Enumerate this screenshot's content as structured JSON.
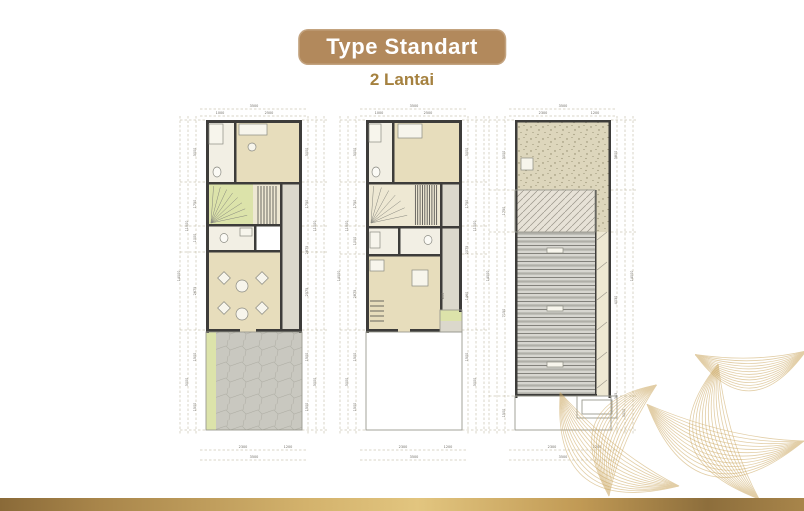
{
  "header": {
    "badge_label": "Type Standart",
    "subtitle": "2 Lantai"
  },
  "colors": {
    "badge": "#b2895c",
    "subtitle_text": "#a5813f",
    "wall": "#3d3c3a",
    "dim_text": "#6e6b64",
    "guide_line": "#b5ad90",
    "gold_bar": "#c19a55",
    "leaf_line": "#cba760",
    "rooms": {
      "white": "#f2efe4",
      "beige": "#e7ddbc",
      "cream": "#eee8d3",
      "green": "#dce3aa",
      "gray": "#dbd8cc",
      "paving": "paving",
      "speckle": "speckle",
      "hatch": "hatch",
      "roof": "roof"
    }
  },
  "plans": [
    {
      "name": "first-floor-plan",
      "stubs": [
        20,
        82,
        126,
        152,
        230,
        330
      ],
      "rooms": [
        [
          34,
          20,
          30,
          64,
          "white"
        ],
        [
          64,
          20,
          66,
          64,
          "beige"
        ],
        [
          34,
          84,
          47,
          42,
          "green"
        ],
        [
          81,
          84,
          27,
          42,
          "cream"
        ],
        [
          108,
          84,
          22,
          148,
          "gray"
        ],
        [
          34,
          126,
          48,
          26,
          "white"
        ],
        [
          34,
          152,
          74,
          80,
          "beige"
        ],
        [
          34,
          232,
          10,
          98,
          "green"
        ],
        [
          44,
          232,
          86,
          98,
          "paving"
        ]
      ],
      "walls": [
        [
          34,
          20,
          96,
          3
        ],
        [
          34,
          20,
          3,
          213
        ],
        [
          127,
          20,
          3,
          213
        ],
        [
          62,
          20,
          2.5,
          64
        ],
        [
          34,
          82,
          96,
          2.5
        ],
        [
          34,
          124,
          76,
          2.5
        ],
        [
          34,
          150,
          76,
          2.5
        ],
        [
          82,
          124,
          2.5,
          28
        ],
        [
          108,
          84,
          2.5,
          148
        ],
        [
          34,
          229,
          34,
          3
        ],
        [
          84,
          229,
          46,
          3
        ]
      ],
      "features": [
        {
          "t": "outline",
          "x": 34,
          "y": 232,
          "w": 96,
          "h": 98
        },
        {
          "t": "fan",
          "x": 39,
          "y": 123,
          "r": 37,
          "a1": -86,
          "a2": -12,
          "n": 7
        },
        {
          "t": "hsteps",
          "x": 83,
          "y": 86,
          "w": 24,
          "h": 38,
          "n": 7
        },
        {
          "t": "box",
          "x": 67,
          "y": 24,
          "w": 28,
          "h": 11
        },
        {
          "t": "circle",
          "x": 80,
          "y": 47,
          "r": 4
        },
        {
          "t": "box",
          "x": 37,
          "y": 24,
          "w": 14,
          "h": 20
        },
        {
          "t": "oval",
          "x": 45,
          "y": 72,
          "rx": 4,
          "ry": 5
        },
        {
          "t": "oval",
          "x": 52,
          "y": 138,
          "rx": 4,
          "ry": 4.5
        },
        {
          "t": "box",
          "x": 68,
          "y": 128,
          "w": 12,
          "h": 8
        },
        {
          "t": "circle",
          "x": 70,
          "y": 186,
          "r": 6
        },
        {
          "t": "circle",
          "x": 70,
          "y": 214,
          "r": 6
        },
        {
          "t": "dbox",
          "x": 52,
          "y": 178,
          "s": 9
        },
        {
          "t": "dbox",
          "x": 90,
          "y": 178,
          "s": 9
        },
        {
          "t": "dbox",
          "x": 52,
          "y": 208,
          "s": 9
        },
        {
          "t": "dbox",
          "x": 90,
          "y": 208,
          "s": 9
        }
      ],
      "dims": [
        [
          "3500",
          82,
          7,
          0
        ],
        [
          "1000",
          48,
          14,
          0
        ],
        [
          "2500",
          97,
          14,
          0
        ],
        [
          "3000",
          24,
          52,
          1
        ],
        [
          "1750",
          24,
          104,
          1
        ],
        [
          "1000",
          24,
          138,
          1
        ],
        [
          "2675",
          24,
          191,
          1
        ],
        [
          "1500",
          24,
          257,
          1
        ],
        [
          "1500",
          24,
          307,
          1
        ],
        [
          "11000",
          16,
          126,
          1
        ],
        [
          "3000",
          16,
          282,
          1
        ],
        [
          "14000",
          8,
          176,
          1
        ],
        [
          "3000",
          136,
          52,
          1
        ],
        [
          "1750",
          136,
          104,
          1
        ],
        [
          "2875",
          136,
          150,
          1
        ],
        [
          "2575",
          136,
          192,
          1
        ],
        [
          "1500",
          136,
          257,
          1
        ],
        [
          "1500",
          136,
          307,
          1
        ],
        [
          "11000",
          144,
          126,
          1
        ],
        [
          "3000",
          144,
          282,
          1
        ],
        [
          "2300",
          71,
          348,
          0
        ],
        [
          "1200",
          116,
          348,
          0
        ],
        [
          "3500",
          82,
          358,
          0
        ]
      ]
    },
    {
      "name": "second-floor-plan",
      "stubs": [
        20,
        82,
        126,
        154,
        230,
        330
      ],
      "rooms": [
        [
          34,
          20,
          28,
          64,
          "white"
        ],
        [
          62,
          20,
          68,
          64,
          "beige"
        ],
        [
          34,
          84,
          47,
          42,
          "cream"
        ],
        [
          81,
          84,
          27,
          42,
          "cream"
        ],
        [
          108,
          84,
          22,
          126,
          "gray"
        ],
        [
          34,
          128,
          33,
          26,
          "white"
        ],
        [
          67,
          128,
          41,
          26,
          "white"
        ],
        [
          34,
          156,
          74,
          76,
          "beige"
        ],
        [
          108,
          210,
          22,
          11,
          "green"
        ],
        [
          108,
          221,
          22,
          11,
          "gray"
        ]
      ],
      "walls": [
        [
          34,
          20,
          96,
          3
        ],
        [
          34,
          20,
          3,
          213
        ],
        [
          127,
          20,
          3,
          192
        ],
        [
          60,
          20,
          2.5,
          64
        ],
        [
          34,
          82,
          96,
          2.5
        ],
        [
          34,
          126,
          96,
          2.5
        ],
        [
          34,
          154,
          76,
          2.5
        ],
        [
          66,
          128,
          2.5,
          26
        ],
        [
          108,
          84,
          2.5,
          126
        ],
        [
          34,
          229,
          32,
          3
        ],
        [
          78,
          229,
          30,
          3
        ]
      ],
      "features": [
        {
          "t": "outline",
          "x": 34,
          "y": 232,
          "w": 96,
          "h": 98
        },
        {
          "t": "outline",
          "x": 108,
          "y": 210,
          "w": 22,
          "h": 22
        },
        {
          "t": "fan",
          "x": 39,
          "y": 123,
          "r": 37,
          "a1": -86,
          "a2": -12,
          "n": 6
        },
        {
          "t": "hsteps",
          "x": 81,
          "y": 85,
          "w": 26,
          "h": 40,
          "n": 10
        },
        {
          "t": "box",
          "x": 66,
          "y": 24,
          "w": 24,
          "h": 14
        },
        {
          "t": "box",
          "x": 37,
          "y": 24,
          "w": 12,
          "h": 18
        },
        {
          "t": "oval",
          "x": 44,
          "y": 72,
          "rx": 4,
          "ry": 5
        },
        {
          "t": "oval",
          "x": 96,
          "y": 140,
          "rx": 4,
          "ry": 4.5
        },
        {
          "t": "box",
          "x": 38,
          "y": 132,
          "w": 10,
          "h": 16
        },
        {
          "t": "box",
          "x": 38,
          "y": 160,
          "w": 14,
          "h": 11
        },
        {
          "t": "vsteps",
          "x": 38,
          "y": 196,
          "w": 14,
          "h": 30,
          "n": 5
        },
        {
          "t": "box",
          "x": 80,
          "y": 170,
          "w": 16,
          "h": 16
        }
      ],
      "dims": [
        [
          "3500",
          82,
          7,
          0
        ],
        [
          "1000",
          47,
          14,
          0
        ],
        [
          "2500",
          96,
          14,
          0
        ],
        [
          "3000",
          24,
          52,
          1
        ],
        [
          "1750",
          24,
          104,
          1
        ],
        [
          "1000",
          24,
          141,
          1
        ],
        [
          "2875",
          24,
          194,
          1
        ],
        [
          "1500",
          24,
          257,
          1
        ],
        [
          "1500",
          24,
          307,
          1
        ],
        [
          "11000",
          16,
          126,
          1
        ],
        [
          "3000",
          16,
          282,
          1
        ],
        [
          "14000",
          8,
          176,
          1
        ],
        [
          "3000",
          136,
          52,
          1
        ],
        [
          "1750",
          136,
          104,
          1
        ],
        [
          "2075",
          136,
          150,
          1
        ],
        [
          "1460",
          136,
          196,
          1
        ],
        [
          "800",
          112,
          196,
          1
        ],
        [
          "1500",
          136,
          257,
          1
        ],
        [
          "11000",
          144,
          126,
          1
        ],
        [
          "3000",
          144,
          282,
          1
        ],
        [
          "2300",
          71,
          348,
          0
        ],
        [
          "1200",
          116,
          348,
          0
        ],
        [
          "3500",
          82,
          358,
          0
        ]
      ]
    },
    {
      "name": "roof-plan",
      "stubs": [
        20,
        90,
        132,
        296,
        330
      ],
      "rooms": [
        [
          34,
          20,
          96,
          70,
          "speckle"
        ],
        [
          34,
          90,
          80,
          42,
          "hatch"
        ],
        [
          114,
          90,
          16,
          42,
          "speckle"
        ],
        [
          34,
          132,
          80,
          164,
          "roof"
        ],
        [
          114,
          132,
          16,
          164,
          "cream"
        ]
      ],
      "walls": [
        [
          34,
          20,
          96,
          2.5
        ],
        [
          34,
          20,
          2.5,
          278
        ],
        [
          127.5,
          20,
          2.5,
          278
        ],
        [
          114,
          90,
          1.5,
          206
        ],
        [
          34,
          294,
          82,
          2.5
        ]
      ],
      "features": [
        {
          "t": "outline",
          "x": 34,
          "y": 90,
          "w": 80,
          "h": 42
        },
        {
          "t": "outline",
          "x": 34,
          "y": 296,
          "w": 96,
          "h": 34
        },
        {
          "t": "outline",
          "x": 96,
          "y": 296,
          "w": 40,
          "h": 22
        },
        {
          "t": "outline",
          "x": 101,
          "y": 300,
          "w": 30,
          "h": 14
        },
        {
          "t": "diag",
          "x1": 116,
          "y1": 140,
          "x2": 126,
          "y2": 132
        },
        {
          "t": "diag",
          "x1": 116,
          "y1": 170,
          "x2": 126,
          "y2": 162
        },
        {
          "t": "diag",
          "x1": 116,
          "y1": 200,
          "x2": 126,
          "y2": 192
        },
        {
          "t": "diag",
          "x1": 116,
          "y1": 230,
          "x2": 126,
          "y2": 222
        },
        {
          "t": "diag",
          "x1": 116,
          "y1": 260,
          "x2": 126,
          "y2": 252
        },
        {
          "t": "diag",
          "x1": 116,
          "y1": 288,
          "x2": 126,
          "y2": 280
        },
        {
          "t": "box",
          "x": 40,
          "y": 58,
          "w": 12,
          "h": 12
        },
        {
          "t": "box",
          "x": 66,
          "y": 148,
          "w": 16,
          "h": 5
        },
        {
          "t": "box",
          "x": 66,
          "y": 206,
          "w": 16,
          "h": 5
        },
        {
          "t": "box",
          "x": 66,
          "y": 262,
          "w": 16,
          "h": 5
        }
      ],
      "dims": [
        [
          "3500",
          82,
          7,
          0
        ],
        [
          "2300",
          62,
          14,
          0
        ],
        [
          "1200",
          114,
          14,
          0
        ],
        [
          "3000",
          24,
          55,
          1
        ],
        [
          "1750",
          24,
          111,
          1
        ],
        [
          "7150",
          24,
          213,
          1
        ],
        [
          "1500",
          24,
          313,
          1
        ],
        [
          "14000",
          8,
          176,
          1
        ],
        [
          "3800",
          136,
          55,
          1
        ],
        [
          "4030",
          136,
          200,
          1
        ],
        [
          "345",
          136,
          296,
          1
        ],
        [
          "3000",
          144,
          313,
          1
        ],
        [
          "14000",
          152,
          176,
          1
        ],
        [
          "2300",
          71,
          348,
          0
        ],
        [
          "1200",
          116,
          348,
          0
        ],
        [
          "3500",
          82,
          358,
          0
        ]
      ]
    }
  ]
}
